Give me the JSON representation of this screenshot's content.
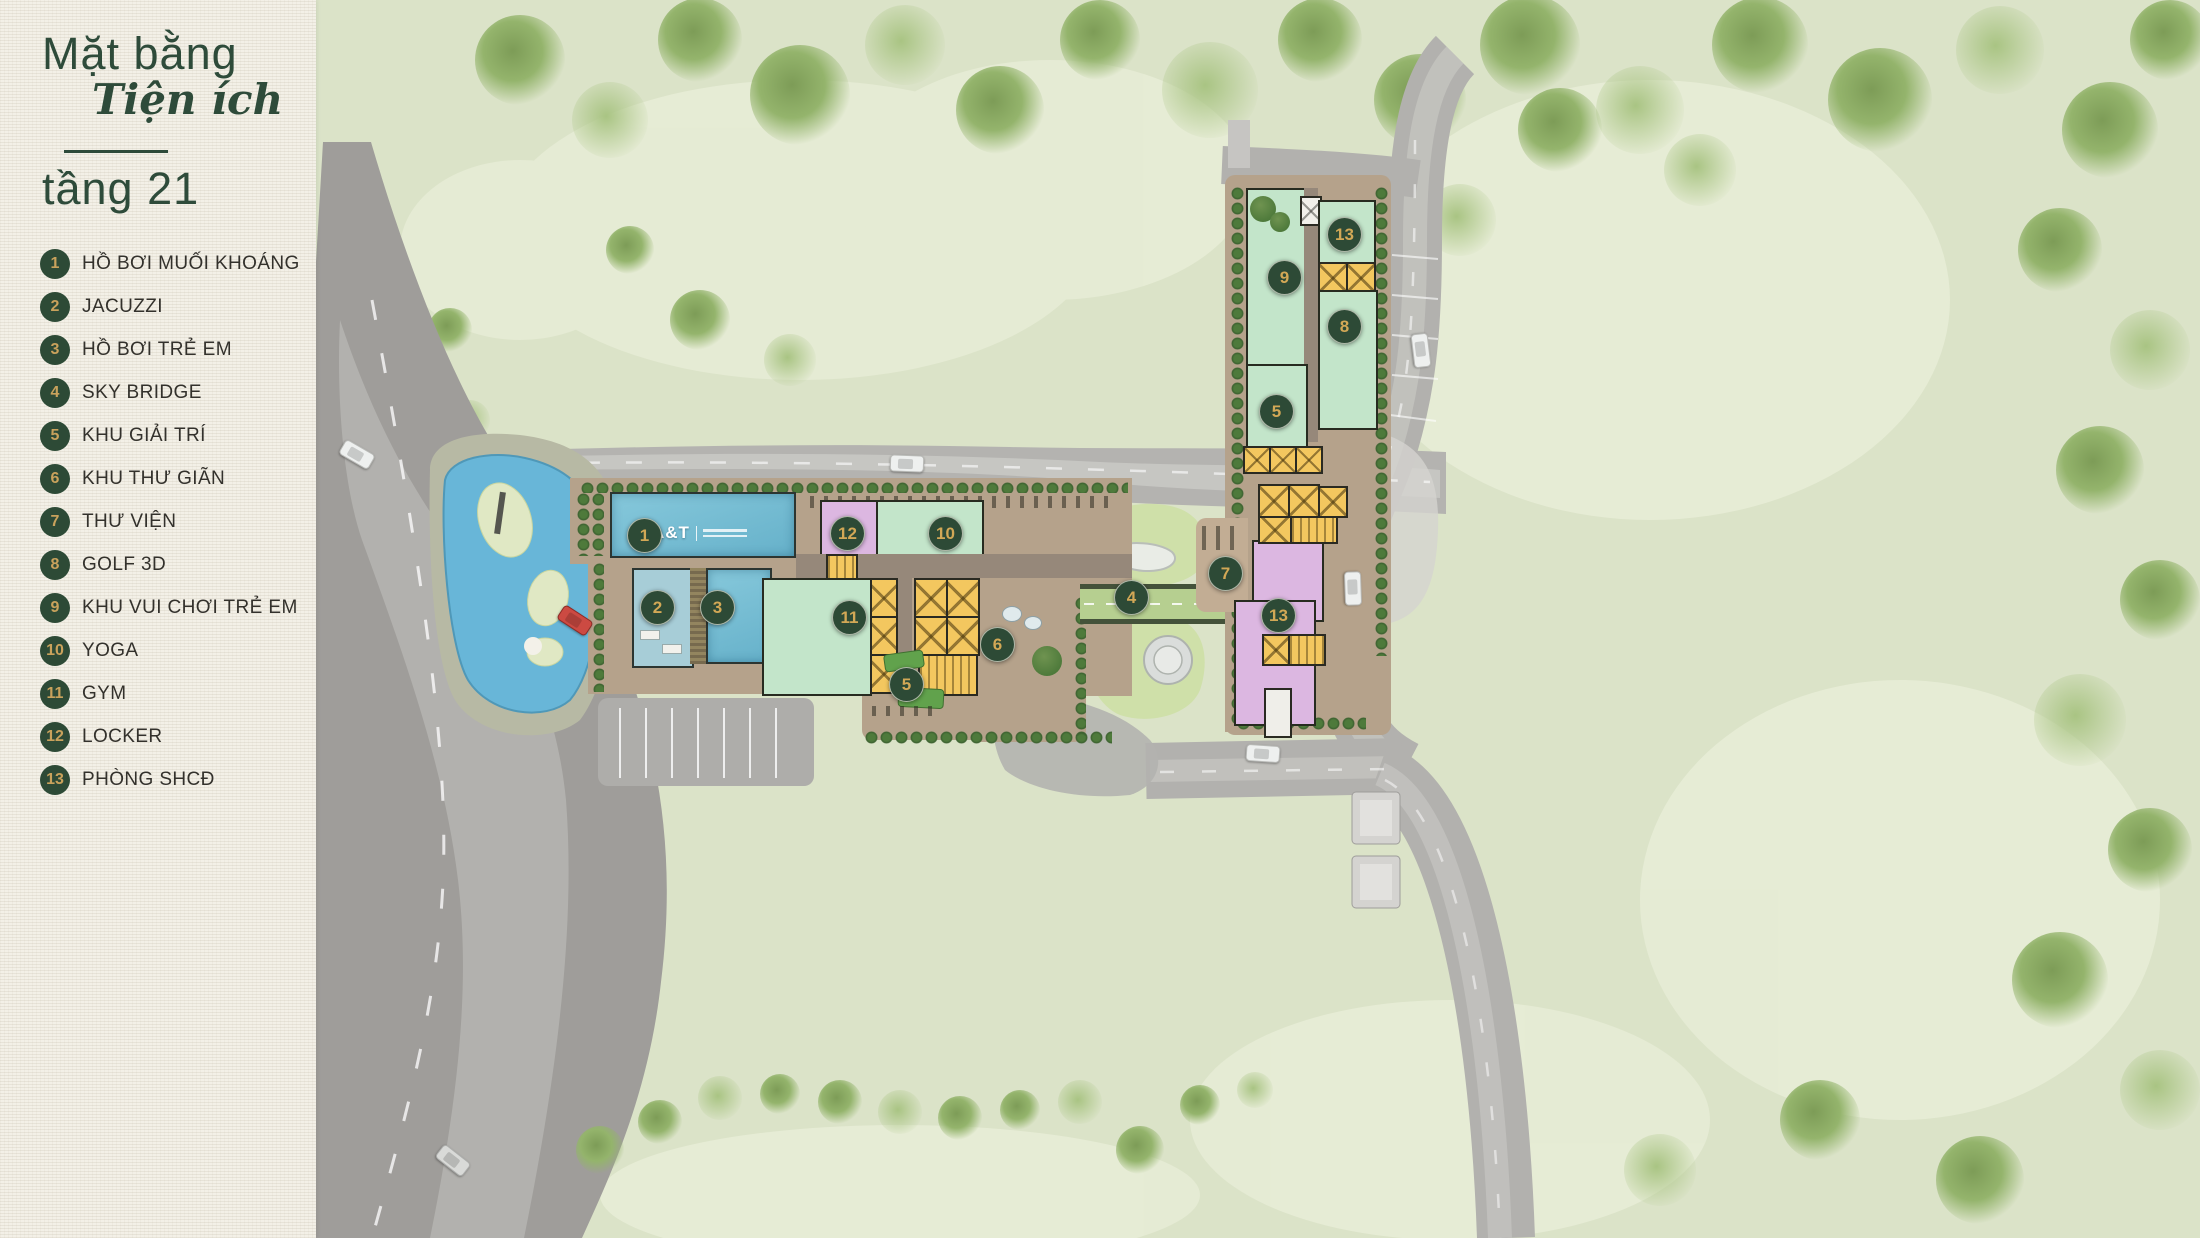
{
  "panel": {
    "title": "Mặt bằng",
    "subtitle_script": "Tiện ích",
    "floor": "tầng 21",
    "colors": {
      "accent_green": "#2d4a36",
      "gold": "#c9a25c",
      "panel_bg": "#f3f0e7"
    }
  },
  "legend": {
    "items": [
      {
        "number": "1",
        "label": "HỒ BƠI MUỐI KHOÁNG"
      },
      {
        "number": "2",
        "label": "JACUZZI"
      },
      {
        "number": "3",
        "label": "HỒ BƠI TRẺ EM"
      },
      {
        "number": "4",
        "label": "SKY BRIDGE"
      },
      {
        "number": "5",
        "label": "KHU GIẢI TRÍ"
      },
      {
        "number": "6",
        "label": "KHU THƯ GIÃN"
      },
      {
        "number": "7",
        "label": "THƯ VIỆN"
      },
      {
        "number": "8",
        "label": "GOLF 3D"
      },
      {
        "number": "9",
        "label": "KHU VUI CHƠI TRẺ EM"
      },
      {
        "number": "10",
        "label": "YOGA"
      },
      {
        "number": "11",
        "label": "GYM"
      },
      {
        "number": "12",
        "label": "LOCKER"
      },
      {
        "number": "13",
        "label": "PHÒNG SHCĐ"
      }
    ]
  },
  "map": {
    "pool_logo": "A&T",
    "markers": [
      {
        "number": "1",
        "x": 643,
        "y": 534
      },
      {
        "number": "2",
        "x": 656,
        "y": 606
      },
      {
        "number": "3",
        "x": 716,
        "y": 606
      },
      {
        "number": "4",
        "x": 1130,
        "y": 596
      },
      {
        "number": "5",
        "x": 905,
        "y": 683
      },
      {
        "number": "5",
        "x": 1275,
        "y": 410
      },
      {
        "number": "6",
        "x": 996,
        "y": 643
      },
      {
        "number": "7",
        "x": 1224,
        "y": 572
      },
      {
        "number": "8",
        "x": 1343,
        "y": 325
      },
      {
        "number": "9",
        "x": 1283,
        "y": 276
      },
      {
        "number": "10",
        "x": 944,
        "y": 532
      },
      {
        "number": "11",
        "x": 848,
        "y": 616
      },
      {
        "number": "12",
        "x": 846,
        "y": 532
      },
      {
        "number": "13",
        "x": 1343,
        "y": 233
      },
      {
        "number": "13",
        "x": 1277,
        "y": 614
      }
    ],
    "colors": {
      "grass": "#dbe3c8",
      "road": "#9f9d9a",
      "water": "#6cb8d8",
      "room_mint": "#c3e5ca",
      "room_purple": "#dcb7e1",
      "room_yellow": "#f3c75f",
      "podium_tan": "#b5a28b",
      "bridge_green": "#b6cf90"
    }
  }
}
